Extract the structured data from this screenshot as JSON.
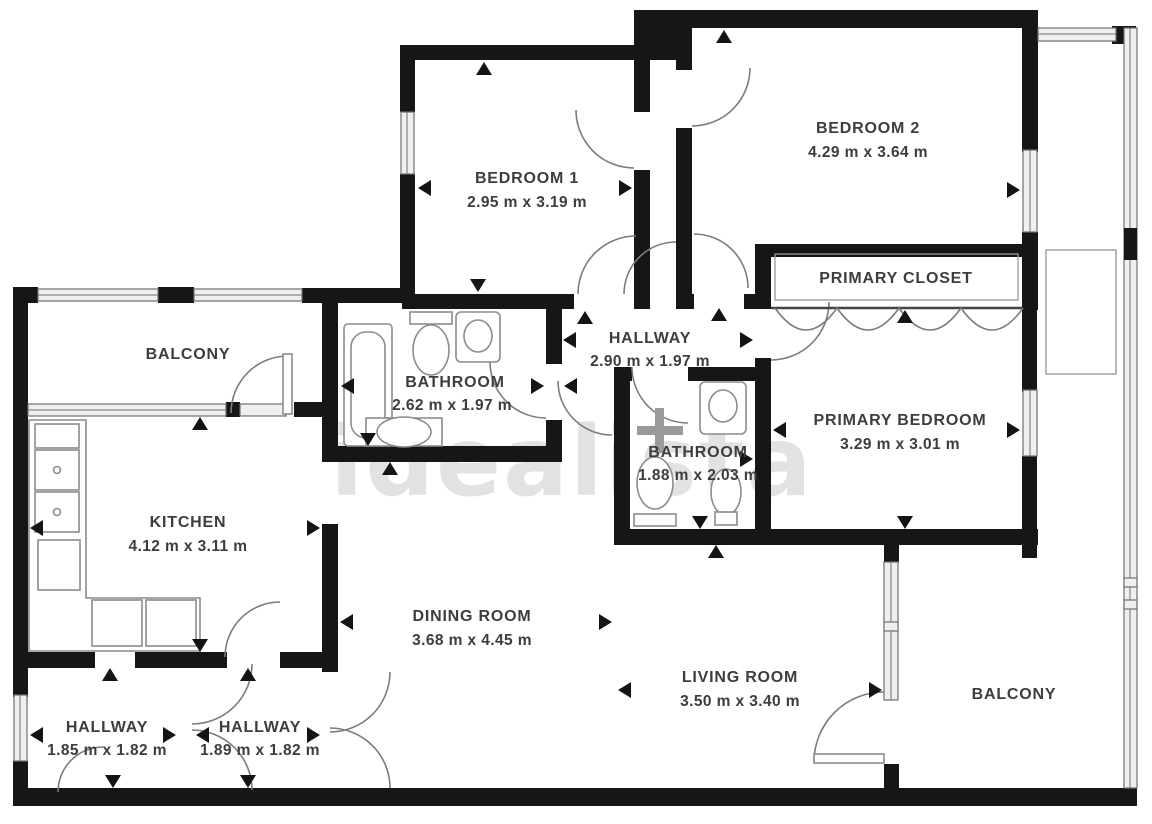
{
  "plan": {
    "watermark": "idealista",
    "rooms": [
      {
        "id": "bedroom-1",
        "name": "BEDROOM 1",
        "dims": "2.95 m x 3.19 m"
      },
      {
        "id": "bedroom-2",
        "name": "BEDROOM 2",
        "dims": "4.29 m x 3.64 m"
      },
      {
        "id": "primary-closet",
        "name": "PRIMARY CLOSET",
        "dims": ""
      },
      {
        "id": "hallway-center",
        "name": "HALLWAY",
        "dims": "2.90 m x 1.97 m"
      },
      {
        "id": "bathroom-main",
        "name": "BATHROOM",
        "dims": "2.62 m x 1.97 m"
      },
      {
        "id": "bathroom-ensuite",
        "name": "BATHROOM",
        "dims": "1.88 m x 2.03 m"
      },
      {
        "id": "primary-bedroom",
        "name": "PRIMARY BEDROOM",
        "dims": "3.29 m x 3.01 m"
      },
      {
        "id": "balcony-top",
        "name": "BALCONY",
        "dims": ""
      },
      {
        "id": "kitchen",
        "name": "KITCHEN",
        "dims": "4.12 m x 3.11 m"
      },
      {
        "id": "dining-room",
        "name": "DINING ROOM",
        "dims": "3.68 m x 4.45 m"
      },
      {
        "id": "living-room",
        "name": "LIVING ROOM",
        "dims": "3.50 m x 3.40 m"
      },
      {
        "id": "balcony-right",
        "name": "BALCONY",
        "dims": ""
      },
      {
        "id": "hallway-left",
        "name": "HALLWAY",
        "dims": "1.85 m x 1.82 m"
      },
      {
        "id": "hallway-mid",
        "name": "HALLWAY",
        "dims": "1.89 m x 1.82 m"
      }
    ],
    "colors": {
      "wall": "#161616",
      "label": "#3d3d3d",
      "fixture_outline": "#8c8c8c",
      "window_fill": "#efefef",
      "watermark": "#cbcbcb"
    }
  }
}
